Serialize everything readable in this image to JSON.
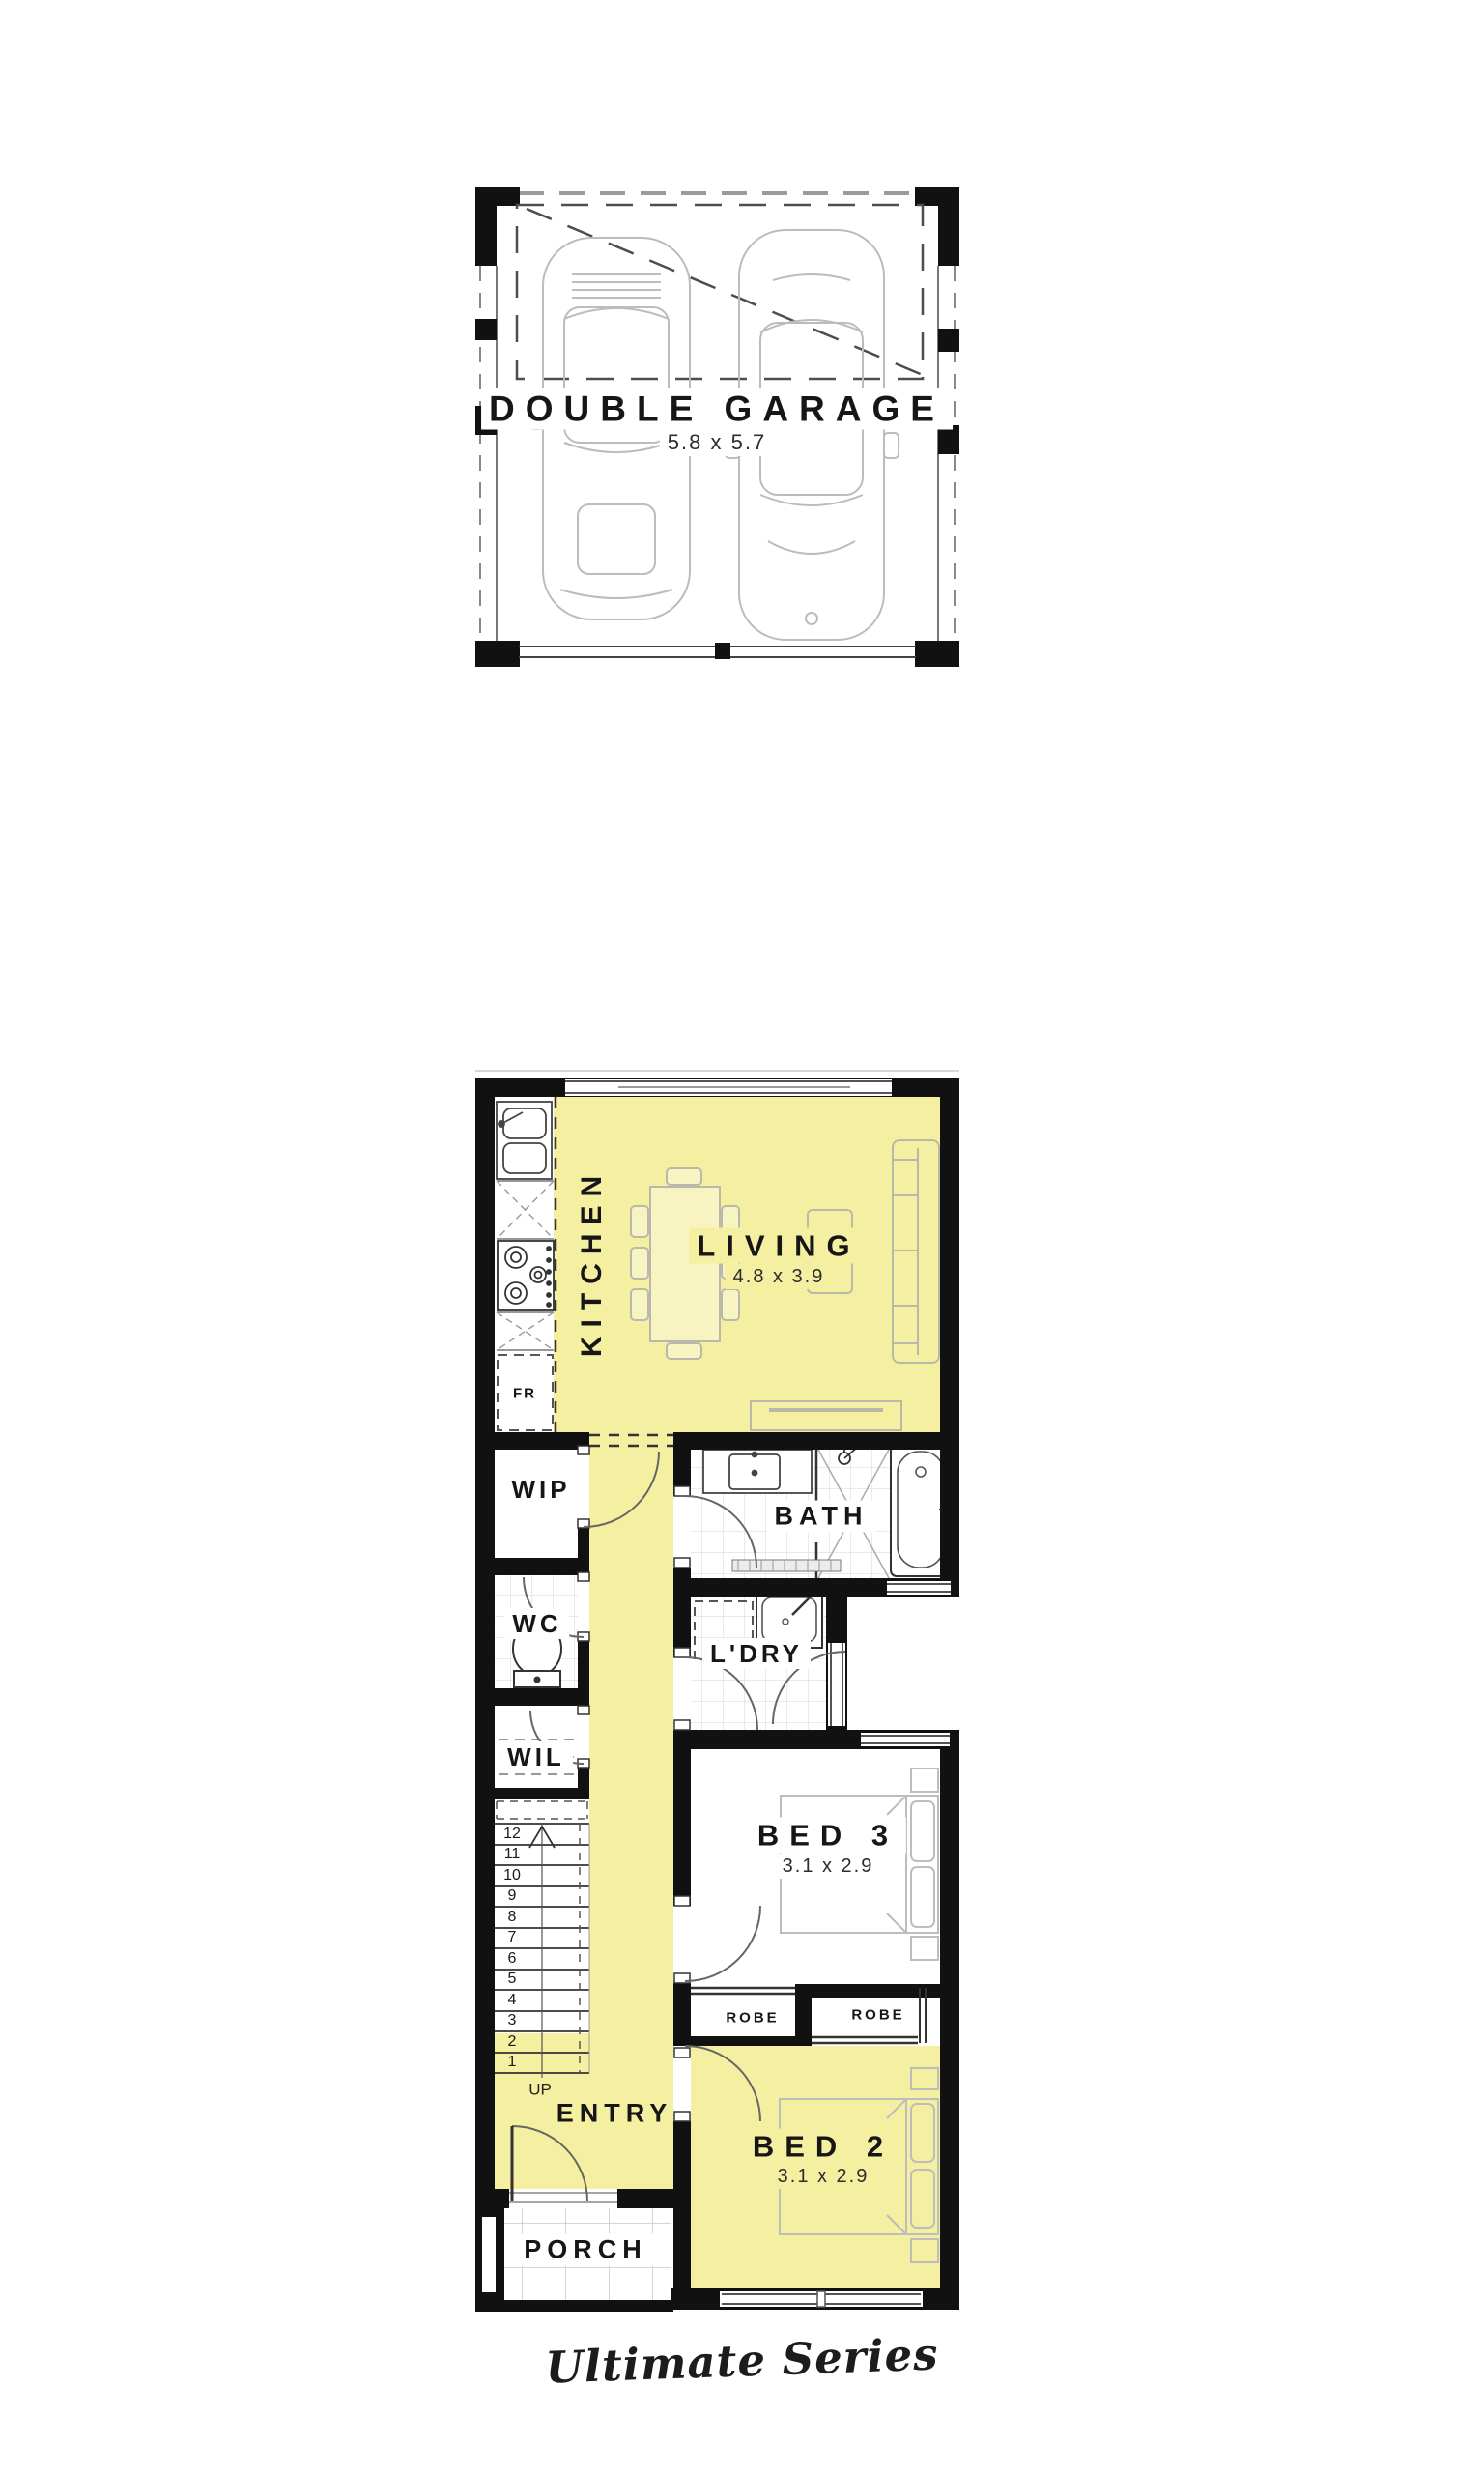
{
  "brand": {
    "series_label": "Ultimate Series"
  },
  "garage_plan": {
    "room": "DOUBLE GARAGE",
    "dimensions": "5.8 x 5.7"
  },
  "floor_plan": {
    "kitchen": {
      "label": "KITCHEN"
    },
    "living": {
      "label": "LIVING",
      "dimensions": "4.8 x 3.9"
    },
    "fridge": {
      "label": "FR"
    },
    "wip": {
      "label": "WIP"
    },
    "wc": {
      "label": "WC"
    },
    "wil": {
      "label": "WIL"
    },
    "bath": {
      "label": "BATH"
    },
    "laundry": {
      "label": "L'DRY"
    },
    "bed3": {
      "label": "BED 3",
      "dimensions": "3.1 x 2.9"
    },
    "robe_bed3": {
      "label": "ROBE"
    },
    "robe_bed2": {
      "label": "ROBE"
    },
    "bed2": {
      "label": "BED 2",
      "dimensions": "3.1 x 2.9"
    },
    "entry": {
      "label": "ENTRY"
    },
    "porch": {
      "label": "PORCH"
    },
    "stairs": {
      "direction_label": "UP",
      "numbers": [
        "12",
        "11",
        "10",
        "9",
        "8",
        "7",
        "6",
        "5",
        "4",
        "3",
        "2",
        "1"
      ]
    }
  },
  "colors": {
    "highlight_yellow": "#F5EFA1",
    "wall_black": "#111111"
  }
}
